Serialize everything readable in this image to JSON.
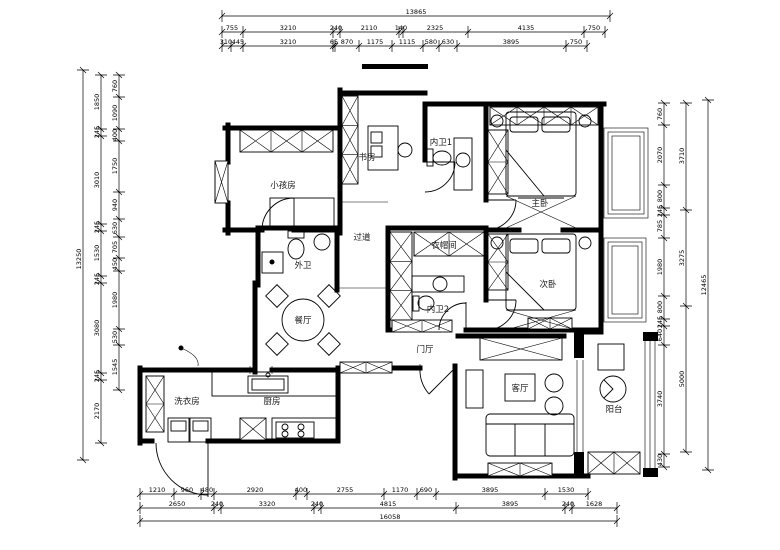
{
  "drawing": {
    "type": "apartment-floor-plan",
    "line_color": "#000000",
    "background": "#ffffff"
  },
  "rooms": {
    "kids": "小孩房",
    "study": "书房",
    "bath1": "内卫1",
    "master": "主卧",
    "corridor": "过道",
    "wardrobe": "衣帽间",
    "second": "次卧",
    "bath_outer": "外卫",
    "bath2": "内卫2",
    "dining": "餐厅",
    "entry": "门厅",
    "living": "客厅",
    "balcony": "阳台",
    "laundry": "洗衣房",
    "kitchen": "厨房"
  },
  "dims": {
    "top_total": "13865",
    "top_row1": [
      "755",
      "3210",
      "240",
      "2110",
      "140",
      "2325",
      "4135",
      "750"
    ],
    "top_row2": [
      "310",
      "445",
      "3210",
      "65",
      "870",
      "1175",
      "1115",
      "580",
      "630",
      "3895",
      "750"
    ],
    "bottom_row1": [
      "1210",
      "960",
      "480",
      "2920",
      "400",
      "2755",
      "1170",
      "690",
      "3895",
      "1530"
    ],
    "bottom_row2": [
      "2650",
      "240",
      "3320",
      "240",
      "4815",
      "3895",
      "240",
      "1628"
    ],
    "bottom_total": "16058",
    "left_total": "13250",
    "left_row1": [
      "1850",
      "245",
      "3010",
      "245",
      "1530",
      "245",
      "3080",
      "245",
      "2170"
    ],
    "left_row2": [
      "760",
      "1090",
      "400",
      "1750",
      "940",
      "630",
      "705",
      "450",
      "1980",
      "530",
      "1545"
    ],
    "right_row1": [
      "760",
      "2070",
      "800",
      "245",
      "785",
      "1980",
      "800",
      "245",
      "640",
      "3740",
      "430"
    ],
    "right_row2": [
      "3710",
      "3275",
      "5000"
    ],
    "right_total": "12465"
  }
}
